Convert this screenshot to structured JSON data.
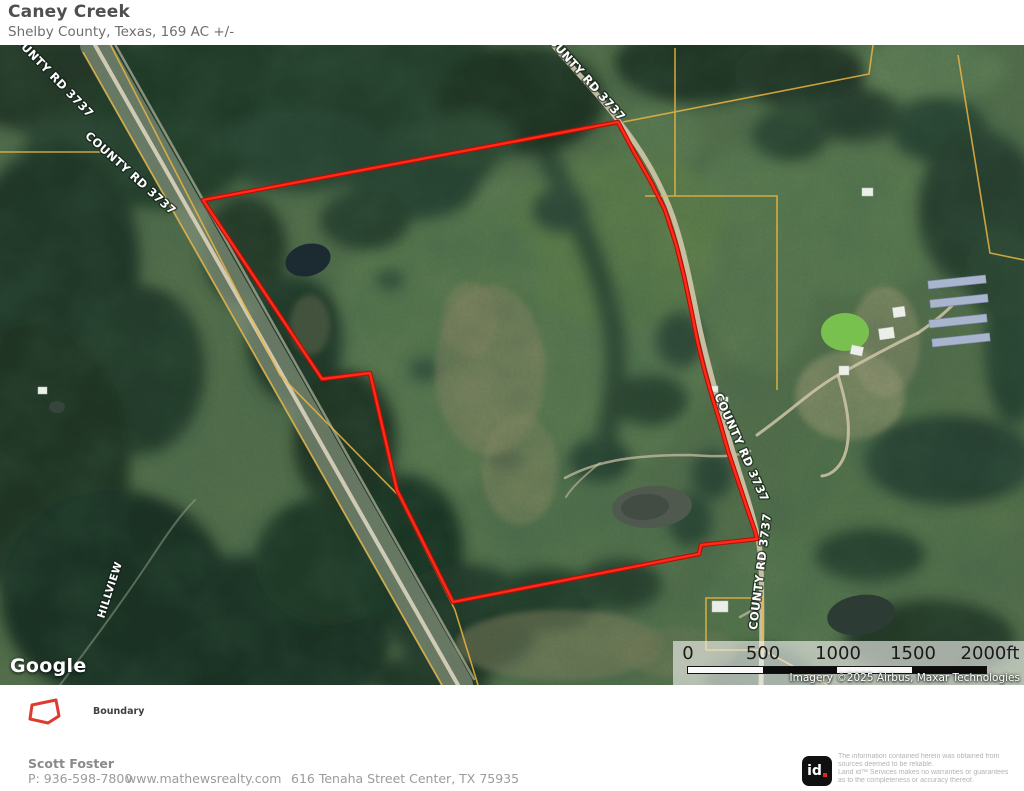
{
  "header": {
    "title": "Caney Creek",
    "subtitle": "Shelby County, Texas, 169 AC +/-"
  },
  "map": {
    "labels": [
      {
        "text": "COUNTY RD 3737"
      },
      {
        "text": "COUNTY RD 3737"
      },
      {
        "text": "COUNTY RD 3737"
      },
      {
        "text": "COUNTY RD 3737"
      },
      {
        "text": "COUNTY RD 3737"
      },
      {
        "text": "HILLVIEW"
      }
    ],
    "google_logo": "Google",
    "attribution": "Imagery ©2025 Airbus, Maxar Technologies",
    "scale": {
      "ticks": [
        "0",
        "500",
        "1000",
        "1500",
        "2000ft"
      ]
    },
    "boundary_color": "#ff2015",
    "parcel_line_color": "#eab542"
  },
  "legend": {
    "items": [
      {
        "label": "Boundary"
      }
    ]
  },
  "footer": {
    "agent": "Scott Foster",
    "phone": "P: 936-598-7800",
    "website": "www.mathewsrealty.com",
    "address": "616 Tenaha Street Center, TX 75935",
    "logo_id": "id",
    "disclaimer_l1": "The information contained herein was obtained from",
    "disclaimer_l2": "sources deemed to be reliable.",
    "disclaimer_l3": " Land id™ Services makes no warranties or guarantees",
    "disclaimer_l4": "as to the completeness or accuracy thereof."
  }
}
